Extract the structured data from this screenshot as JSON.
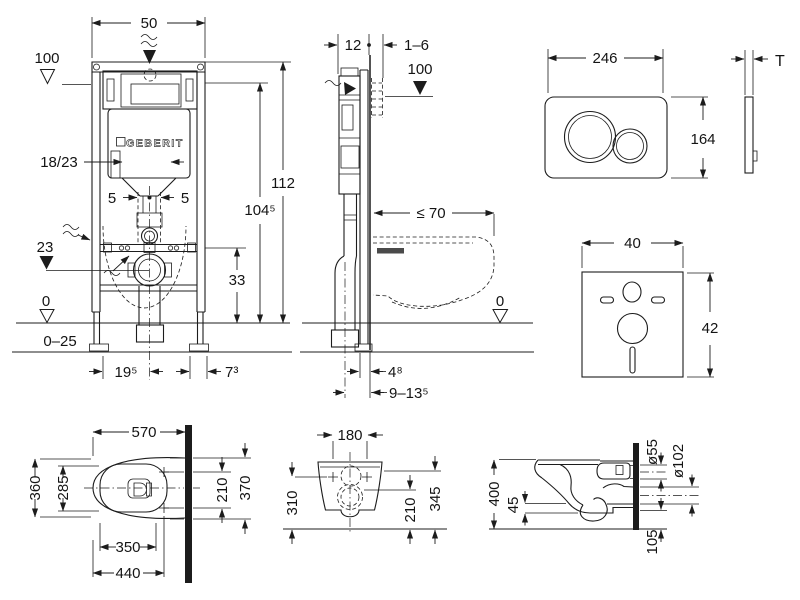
{
  "page": {
    "background": "#ffffff",
    "line_color": "#1c1c1c"
  },
  "views": {
    "frame_front": {
      "brand": "GEBERIT",
      "dims": {
        "width": "50",
        "level": "100",
        "opening": "18/23",
        "offset_left": "5",
        "offset_right": "5",
        "outlet_center": "23",
        "floor_zero": "0",
        "floor_build_up": "0–25",
        "dist_to_center": "19⁵",
        "dist_to_edge": "7³",
        "fixing_height": "33",
        "plate_level": "104⁵",
        "frame_height": "112"
      }
    },
    "frame_side": {
      "dims": {
        "cistern_depth": "12",
        "wall_finish": "1–6",
        "level": "100",
        "wc_depth_max": "≤ 70",
        "floor_zero": "0",
        "rail_depth": "4⁸",
        "outlet_offset": "9–13⁵"
      }
    },
    "flush_plate": {
      "dims": {
        "width": "246",
        "height": "164",
        "thickness": "T"
      }
    },
    "insulation_mat": {
      "dims": {
        "width": "40",
        "height": "42"
      }
    },
    "wc_top": {
      "dims": {
        "depth": "570",
        "width": "360",
        "inner_width": "285",
        "holes_spacing": "210",
        "seat_width": "370",
        "inner_depth": "350",
        "depth_to_holes": "440"
      }
    },
    "wc_rear": {
      "dims": {
        "holes_spacing": "180",
        "holes_height": "310",
        "outlet_height": "210",
        "top_height": "345"
      }
    },
    "wc_side": {
      "dims": {
        "rim_height": "400",
        "gap": "45",
        "flush_dia": "ø55",
        "outlet_dia": "ø102",
        "bottom_height": "105"
      }
    }
  }
}
